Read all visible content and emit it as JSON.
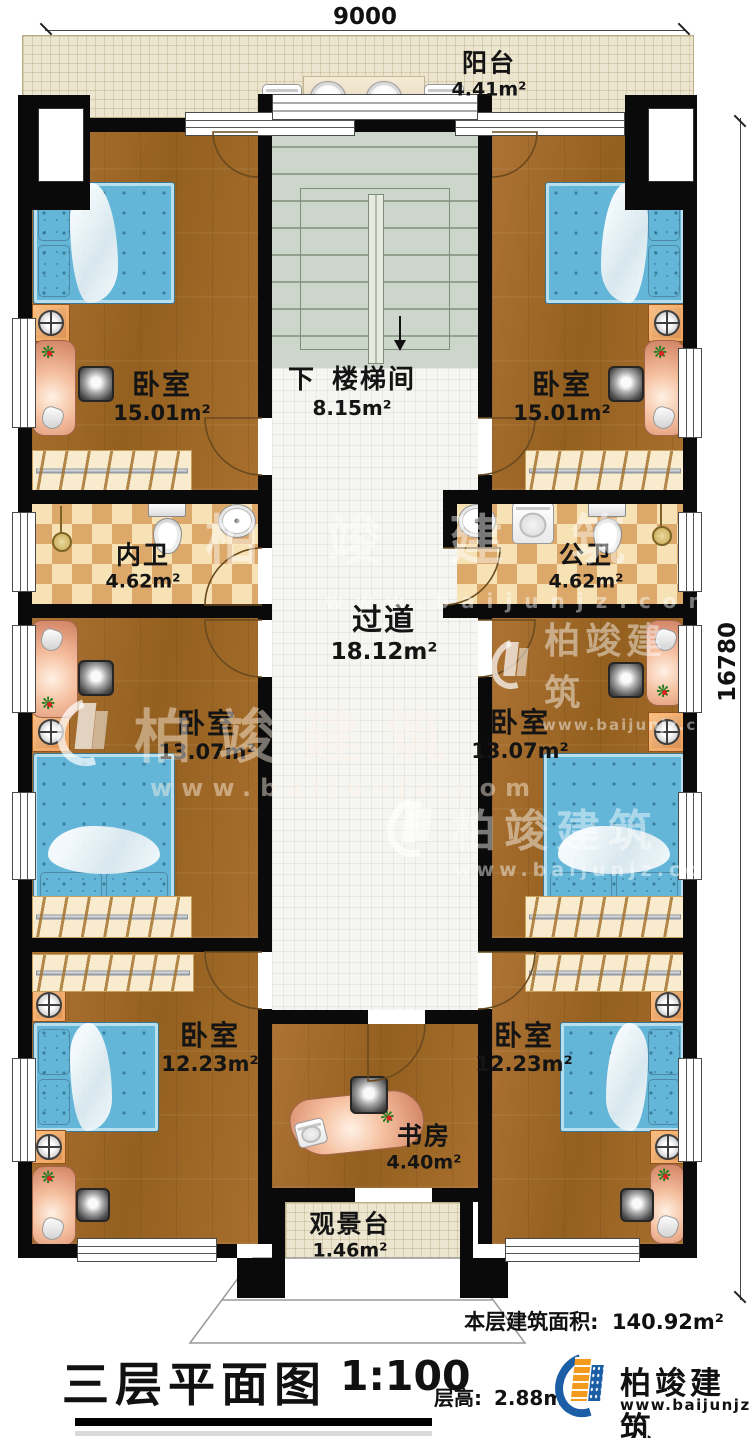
{
  "plan": {
    "dimension_width": "9000",
    "dimension_height": "16780"
  },
  "rooms": [
    {
      "id": "balcony",
      "name": "阳台",
      "area": "4.41m²"
    },
    {
      "id": "bedroom-top-left",
      "name": "卧室",
      "area": "15.01m²"
    },
    {
      "id": "stairwell",
      "prefix": "下",
      "name": "楼梯间",
      "area": "8.15m²"
    },
    {
      "id": "bedroom-top-right",
      "name": "卧室",
      "area": "15.01m²"
    },
    {
      "id": "bath-inner",
      "name": "内卫",
      "area": "4.62m²"
    },
    {
      "id": "bath-public",
      "name": "公卫",
      "area": "4.62m²"
    },
    {
      "id": "corridor",
      "name": "过道",
      "area": "18.12m²"
    },
    {
      "id": "bedroom-mid-left",
      "name": "卧室",
      "area": "13.07m²"
    },
    {
      "id": "bedroom-mid-right",
      "name": "卧室",
      "area": "13.07m²"
    },
    {
      "id": "bedroom-bottom-left",
      "name": "卧室",
      "area": "12.23m²"
    },
    {
      "id": "bedroom-bottom-right",
      "name": "卧室",
      "area": "12.23m²"
    },
    {
      "id": "study",
      "name": "书房",
      "area": "4.40m²"
    },
    {
      "id": "viewing-deck",
      "name": "观景台",
      "area": "1.46m²"
    }
  ],
  "stats": {
    "floor_area_label": "本层建筑面积:",
    "floor_area_value": "140.92m²",
    "floor_height_label": "层高:",
    "floor_height_value": "2.88m"
  },
  "titleblock": {
    "title": "三层平面图",
    "scale": "1:100"
  },
  "brand": {
    "name": "柏竣建筑",
    "url": "www.baijunjz.com"
  },
  "colors": {
    "wall": "#0a0a0a",
    "wood_floor": "#a3692a",
    "bath_tile": "#dca96b",
    "stair": "#ccd6ca",
    "balcony_tile": "#ece5cf",
    "bed": "#64b6d8",
    "desk": "#f0b294",
    "brand_blue": "#1b5ea6",
    "brand_orange": "#f49a1c"
  }
}
